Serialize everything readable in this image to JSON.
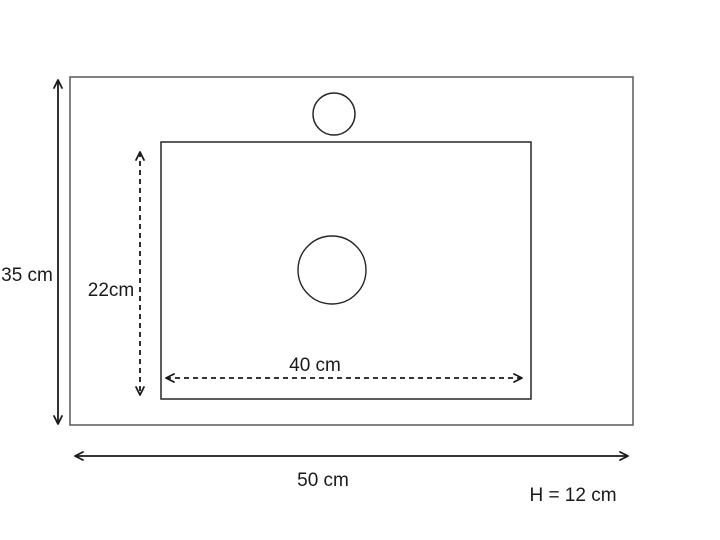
{
  "diagram": {
    "description": "sink-top-dimension-drawing",
    "labels": {
      "outer_height": "35 cm",
      "inner_height": "22cm",
      "inner_width": "40 cm",
      "outer_width": "50 cm",
      "height_note": "H = 12 cm"
    },
    "colors": {
      "line": "#1a1a1a",
      "outer_border": "#595959",
      "inner_border": "#262626",
      "background": "#ffffff"
    }
  }
}
